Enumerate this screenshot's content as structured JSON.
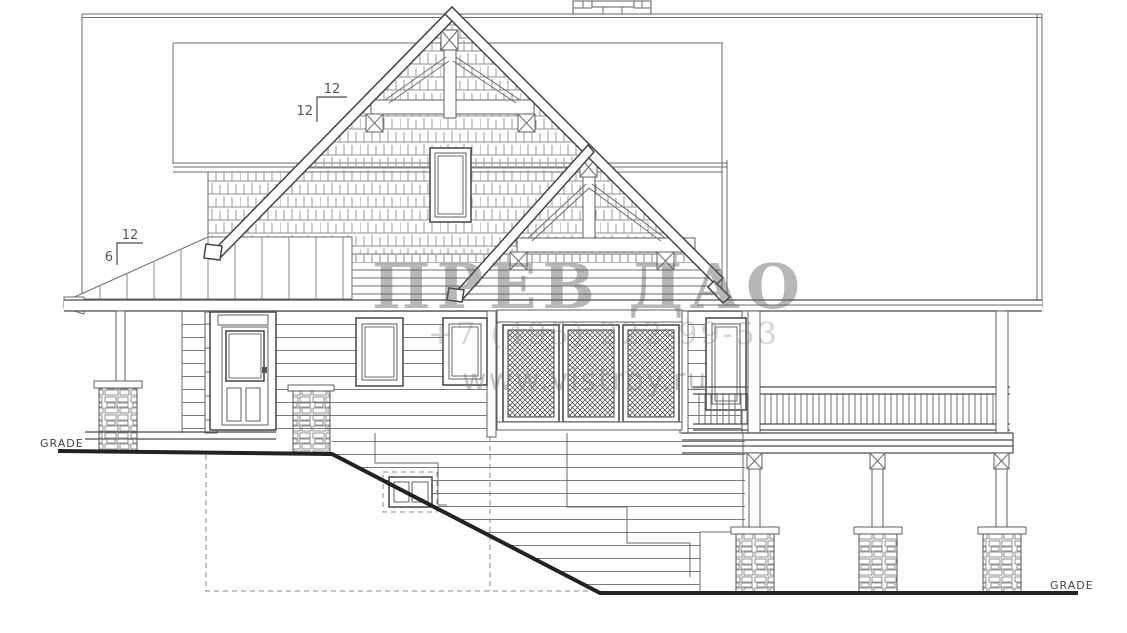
{
  "drawing": {
    "kind": "house side elevation blueprint",
    "annotations": {
      "grade_left": "GRADE",
      "grade_right": "GRADE",
      "pitch_main": {
        "run": "12",
        "rise": "12"
      },
      "pitch_porch": {
        "run": "12",
        "rise": "6"
      }
    },
    "watermark": {
      "brand": "ПРЕВ ДАО",
      "phone": "+7 (495) 222-99-53",
      "website": "www.vistroy.ru"
    },
    "colors": {
      "background": "#ffffff",
      "line": "#6b6b6b",
      "dark_line": "#3d3d3d",
      "grade_line": "#222222",
      "watermark": "#7a7a7a"
    }
  }
}
